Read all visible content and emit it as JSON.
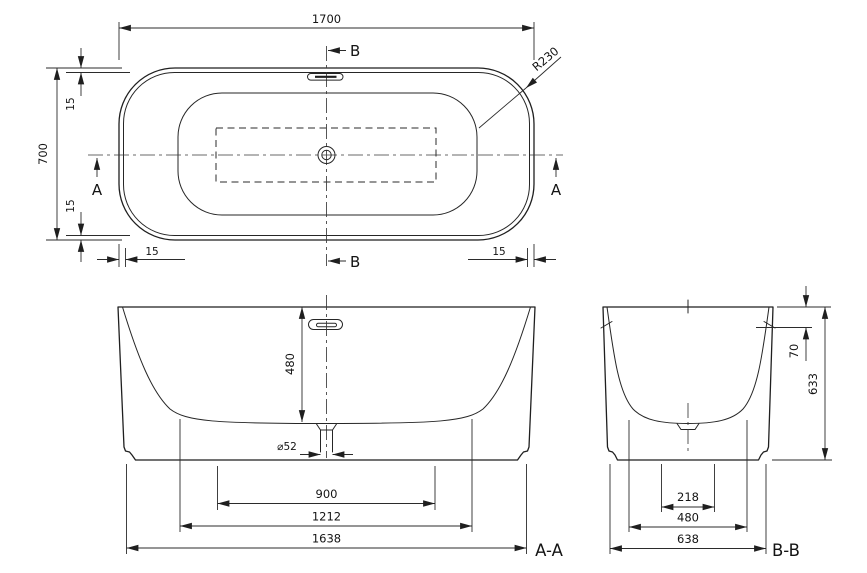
{
  "top_view": {
    "dim_length": "1700",
    "dim_width": "700",
    "dim_rim_left_upper": "15",
    "dim_rim_left_lower": "15",
    "dim_rim_bottom_left": "15",
    "dim_rim_bottom_right": "15",
    "radius": "R230",
    "section_b_top": "B",
    "section_b_bottom": "B",
    "section_a_left": "A",
    "section_a_right": "A"
  },
  "section_aa": {
    "label": "A-A",
    "dim_depth": "480",
    "dim_drain": "⌀52",
    "dim_base_inner": "900",
    "dim_base_mid": "1212",
    "dim_base_outer": "1638"
  },
  "section_bb": {
    "label": "B-B",
    "dim_overflow": "70",
    "dim_height": "633",
    "dim_base_inner": "218",
    "dim_base_mid": "480",
    "dim_base_outer": "638"
  },
  "colors": {
    "background": "#ffffff",
    "line": "#1f1f1f",
    "rim_fill": "#e8e8e8",
    "floor_fill": "#f4f4f4"
  }
}
